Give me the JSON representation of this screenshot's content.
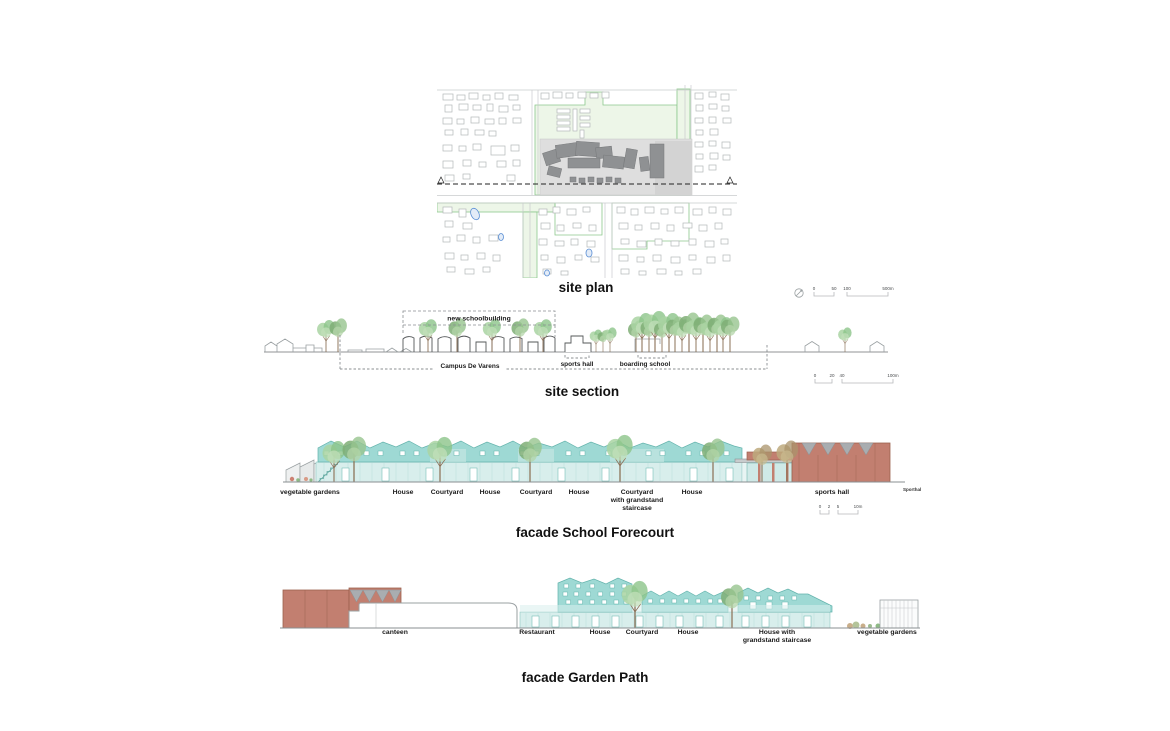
{
  "page": {
    "background": "#ffffff"
  },
  "site_plan": {
    "title": "site plan",
    "scalebar": [
      "0",
      "50",
      "100",
      "500m"
    ]
  },
  "site_section": {
    "title": "site section",
    "callout": "new schoolbuilding",
    "bracket_labels": {
      "campus": "Campus De Varens",
      "sports_hall": "sports hall",
      "boarding_school": "boarding school"
    },
    "scalebar": [
      "0",
      "20",
      "40",
      "100m"
    ]
  },
  "facade_forecourt": {
    "title": "facade School Forecourt",
    "labels": [
      "vegetable gardens",
      "House",
      "Courtyard",
      "House",
      "Courtyard",
      "House",
      "Courtyard\nwith grandstand\nstaircase",
      "House",
      "sports hall"
    ],
    "side_note": "Sporthal",
    "scalebar": [
      "0",
      "2",
      "5",
      "10m"
    ]
  },
  "facade_gardenpath": {
    "title": "facade Garden Path",
    "labels": [
      "canteen",
      "Restaurant",
      "House",
      "Courtyard",
      "House",
      "House with\ngrandstand staircase",
      "vegetable gardens"
    ]
  },
  "colors": {
    "teal_upper": "#9ed9d4",
    "teal_ground": "#d8eeec",
    "brick": "#c27f70",
    "roof_gray": "#a9adb0",
    "tree_green": "#9ccf95",
    "map_green": "#8cc88c",
    "site_gray": "#dedede",
    "building_dark": "#8f9193",
    "pond_blue": "#5b8fd4"
  }
}
